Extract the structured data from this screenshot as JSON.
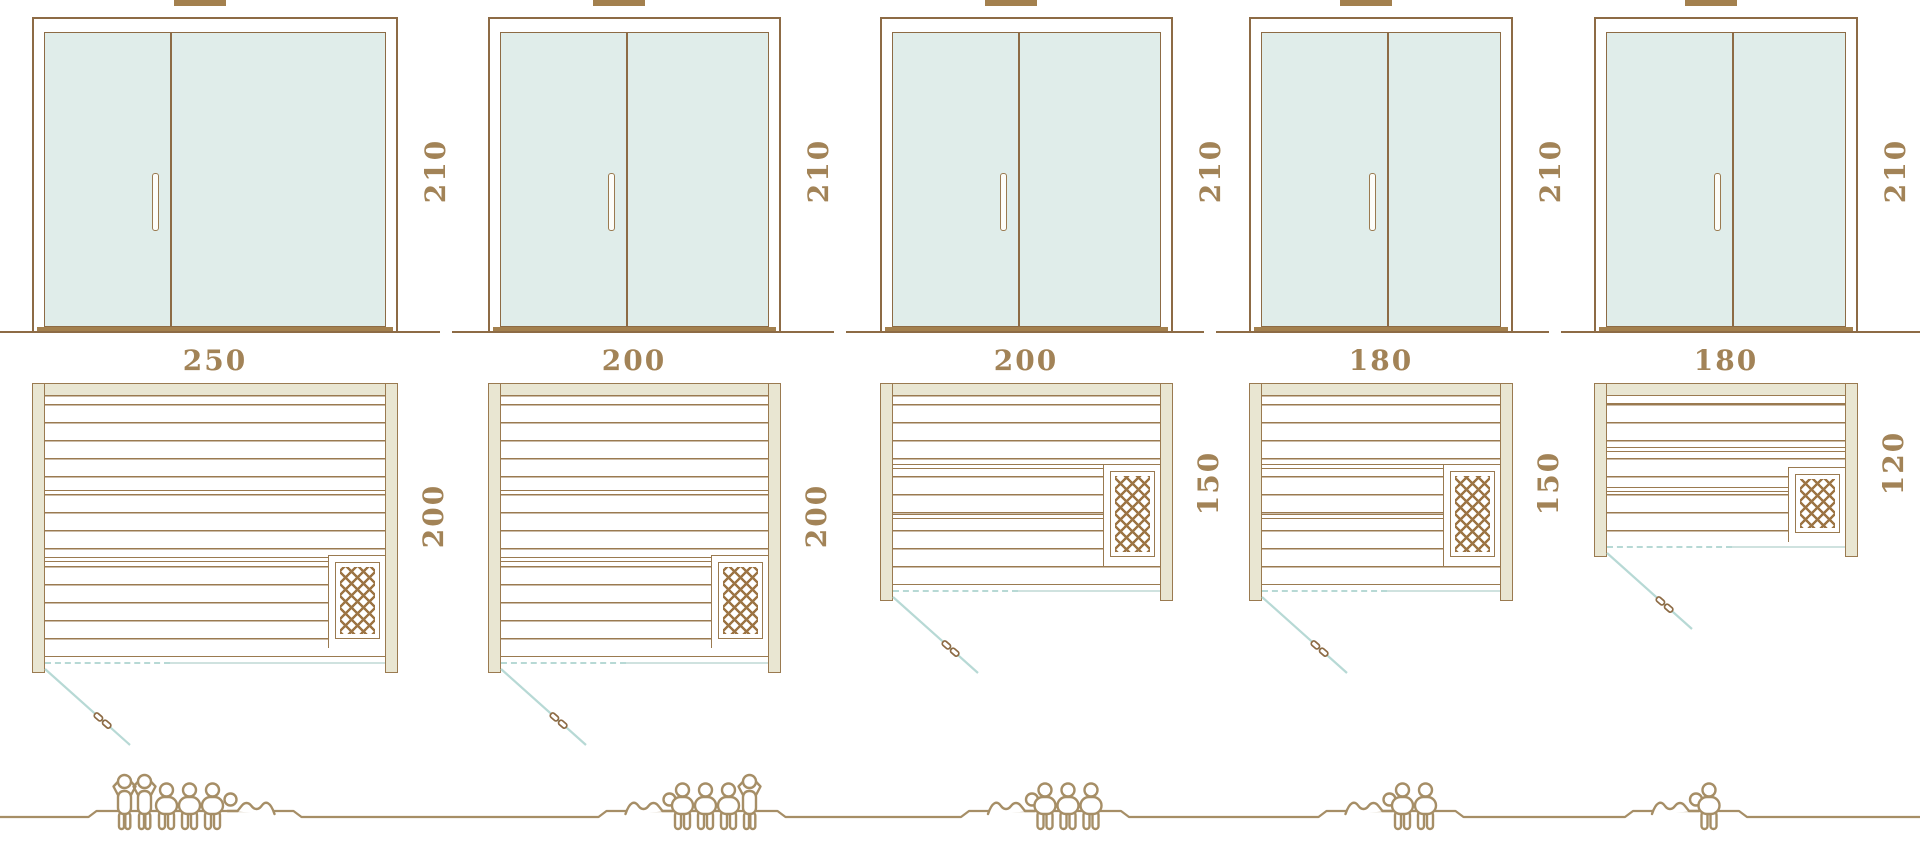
{
  "diagram_title": "",
  "saunas": [
    {
      "id": "sauna-250x200",
      "door_height_label": "210",
      "width_label": "250",
      "depth_label": "200",
      "width_cm": 250,
      "depth_cm": 200,
      "height_cm": 210,
      "capacity_total": 6,
      "capacity_figures": [
        "standing",
        "standing",
        "sitting",
        "sitting",
        "sitting",
        "lying-head-left"
      ]
    },
    {
      "id": "sauna-200x200",
      "door_height_label": "210",
      "width_label": "200",
      "depth_label": "200",
      "width_cm": 200,
      "depth_cm": 200,
      "height_cm": 210,
      "capacity_total": 5,
      "capacity_figures": [
        "lying-head-right",
        "sitting",
        "sitting",
        "sitting",
        "standing"
      ]
    },
    {
      "id": "sauna-200x150",
      "door_height_label": "210",
      "width_label": "200",
      "depth_label": "150",
      "width_cm": 200,
      "depth_cm": 150,
      "height_cm": 210,
      "capacity_total": 4,
      "capacity_figures": [
        "lying-head-right",
        "sitting",
        "sitting",
        "sitting"
      ]
    },
    {
      "id": "sauna-180x150",
      "door_height_label": "210",
      "width_label": "180",
      "depth_label": "150",
      "width_cm": 180,
      "depth_cm": 150,
      "height_cm": 210,
      "capacity_total": 3,
      "capacity_figures": [
        "lying-head-right",
        "sitting",
        "sitting"
      ]
    },
    {
      "id": "sauna-180x120",
      "door_height_label": "210",
      "width_label": "180",
      "depth_label": "120",
      "width_cm": 180,
      "depth_cm": 120,
      "height_cm": 210,
      "capacity_total": 2,
      "capacity_figures": [
        "lying-head-right",
        "sitting"
      ]
    }
  ],
  "colors": {
    "outline": "#8d6b45",
    "wood_light": "#9a7a50",
    "frame_fill": "#e9e6d2",
    "glass": "#e0edea",
    "door_swing": "#b7d9d5",
    "door_swing_solid": "#cfe2df",
    "dimension_text": "#a28357",
    "threshold": "#a3804e",
    "people_outline": "#a68e66",
    "heater_hatch": "#9c7444"
  },
  "icons": {
    "standing_person": "standing-person-icon",
    "sitting_person": "sitting-person-icon",
    "lying_person": "lying-person-icon",
    "door_handle": "door-handle-icon",
    "heater": "heater-hatch-icon",
    "door_swing": "door-swing-line-icon"
  }
}
